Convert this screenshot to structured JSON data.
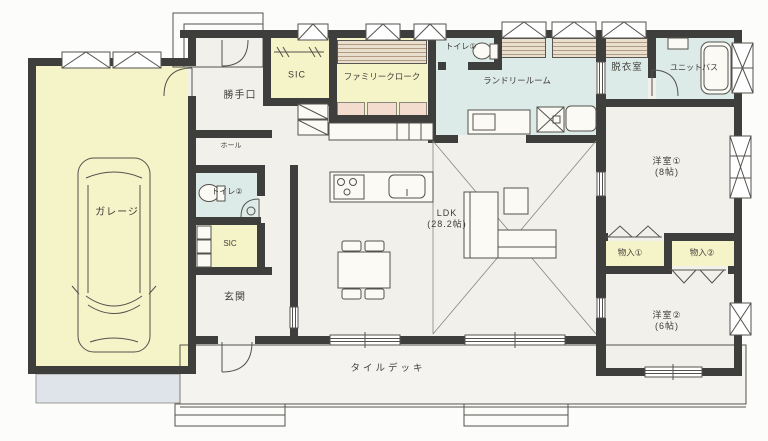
{
  "colors": {
    "bg": "#fcfcfa",
    "wall": "#3e3e3c",
    "line": "#55524e",
    "label": "#3f3d3a",
    "room_yellow": "#f5f3c8",
    "room_blue": "#dcebe7",
    "room_white": "#f1f0eb",
    "deck": "#f4f3ef",
    "driveway": "#dfe3ea",
    "shelf_pink": "#f3dccd",
    "shelf_wood": "#e9dfcf"
  },
  "rooms": {
    "garage": {
      "label": "ガレージ"
    },
    "back_door": {
      "label": "勝手口"
    },
    "hall": {
      "label": "ホール"
    },
    "toilet_2": {
      "label": "トイレ②"
    },
    "sic_entrance": {
      "label": "SIC"
    },
    "entrance": {
      "label": "玄関"
    },
    "sic_upper": {
      "label": "SIC"
    },
    "family_closet": {
      "label": "ファミリークローク"
    },
    "toilet_1": {
      "label": "トイレ①"
    },
    "laundry_room": {
      "label": "ランドリールーム"
    },
    "dressing_room": {
      "label": "脱衣室"
    },
    "unit_bath": {
      "label": "ユニットバス"
    },
    "western_room_1": {
      "label": "洋室①",
      "size": "(8帖)"
    },
    "ldk": {
      "label": "LDK",
      "size": "(28.2帖)"
    },
    "storage_1": {
      "label": "物入①"
    },
    "storage_2": {
      "label": "物入②"
    },
    "western_room_2": {
      "label": "洋室②",
      "size": "(6帖)"
    },
    "tile_deck": {
      "label": "タイルデッキ"
    }
  }
}
